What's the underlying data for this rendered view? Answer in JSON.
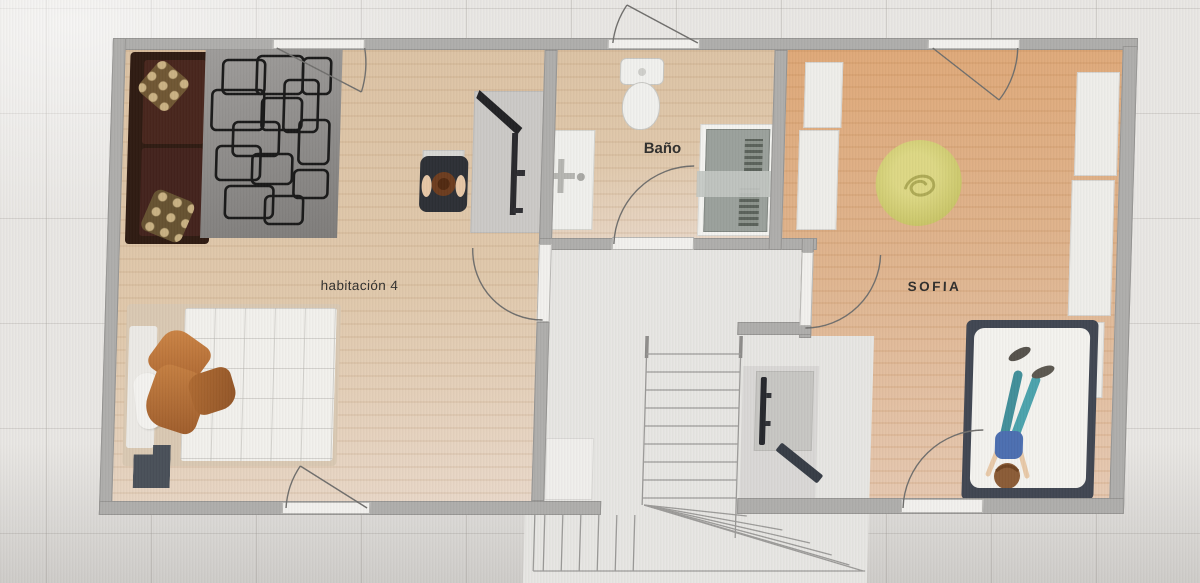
{
  "floor_plan": {
    "title": "second floor plan",
    "rooms": [
      {
        "id": "habitacion-4",
        "label": "habitación 4",
        "floor": "light-wood",
        "furniture": [
          "sofa",
          "patterned-rug",
          "desk",
          "monitor",
          "office-chair",
          "person-sitting",
          "double-bed",
          "orange-pillows",
          "nightstand"
        ]
      },
      {
        "id": "bano",
        "label": "Baño",
        "floor": "light-wood",
        "furniture": [
          "toilet",
          "sink-vanity",
          "washing-machine"
        ]
      },
      {
        "id": "sofia",
        "label": "SOFIA",
        "floor": "orange-wood",
        "furniture": [
          "wardrobes",
          "yellow-pouf",
          "desk",
          "monitor",
          "bed-with-dark-frame",
          "person-lying"
        ]
      },
      {
        "id": "landing",
        "label": "",
        "floor": "gray",
        "furniture": [
          "l-shaped-staircase"
        ]
      }
    ],
    "doors": [
      "door-top-habitacion-4",
      "door-top-bano",
      "door-top-sofia",
      "door-habitacion-4-landing",
      "door-bano-landing",
      "door-sofia-landing",
      "door-bottom-habitacion-4",
      "door-bottom-sofia"
    ],
    "colors": {
      "background": "#e9e7e4",
      "wall": "#aeadab",
      "wood_light": "#dcc2a3",
      "wood_orange": "#dfa877",
      "landing_gray": "#e7e6e3",
      "rug_gray": "#8f8d8b",
      "rug_pattern": "#1a1a1a",
      "sofa_brown": "#2c180f",
      "pillow_orange": "#c17a3e",
      "nightstand_slate": "#474e57",
      "bed_frame_dark": "#3e4450",
      "pouf_yellow": "#d5d37a",
      "person_pants_teal": "#3f8e99",
      "person_top_blue": "#4a6db0",
      "label_text": "#2e2d2b"
    }
  }
}
